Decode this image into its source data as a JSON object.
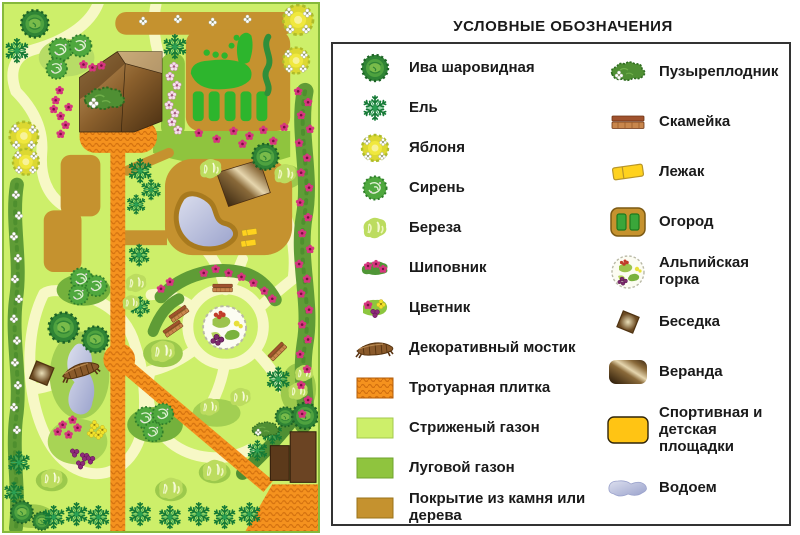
{
  "legend": {
    "title": "УСЛОВНЫЕ ОБОЗНАЧЕНИЯ",
    "left": [
      {
        "icon": "willow",
        "label": "Ива шаровидная"
      },
      {
        "icon": "spruce",
        "label": "Ель"
      },
      {
        "icon": "apple",
        "label": "Яблоня"
      },
      {
        "icon": "lilac",
        "label": "Сирень"
      },
      {
        "icon": "birch",
        "label": "Береза"
      },
      {
        "icon": "rosehip",
        "label": "Шиповник"
      },
      {
        "icon": "flowerbed",
        "label": "Цветник"
      },
      {
        "icon": "bridge",
        "label": "Декоративный мостик"
      },
      {
        "icon": "paving",
        "label": "Тротуарная плитка"
      },
      {
        "icon": "lawn_trim",
        "label": "Стриженый газон"
      },
      {
        "icon": "lawn_meadow",
        "label": "Луговой газон"
      },
      {
        "icon": "stone",
        "label": "Покрытие из камня или дерева"
      }
    ],
    "right": [
      {
        "icon": "ninebark",
        "label": "Пузыреплодник"
      },
      {
        "icon": "bench",
        "label": "Скамейка"
      },
      {
        "icon": "lounger",
        "label": "Лежак"
      },
      {
        "icon": "garden",
        "label": "Огород"
      },
      {
        "icon": "alpine",
        "label": "Альпийская горка"
      },
      {
        "icon": "gazebo",
        "label": "Беседка"
      },
      {
        "icon": "veranda",
        "label": "Веранда"
      },
      {
        "icon": "playground",
        "label": "Спортивная и детская площадки"
      },
      {
        "icon": "pond",
        "label": "Водоем"
      }
    ]
  },
  "palette": {
    "lawn_trim": "#cdef6a",
    "lawn_meadow": "#8fc43e",
    "walkway": "#f7f8c6",
    "hedge": "#5f9c36",
    "hedge_dark": "#4e8f2e",
    "paving": "#f5921e",
    "paving_dark": "#c96a08",
    "stone": "#c5922f",
    "stone_dark": "#a87a1e",
    "water_light": "#d4d8ea",
    "water_dark": "#8f97c6",
    "wood": "#6b4423",
    "wood_dark": "#3a2710",
    "pink": "#d6367f",
    "yellow": "#f2e32b",
    "purple": "#8e2a7a",
    "legend_border": "#333333",
    "title_color": "#1a1a1a",
    "page_bg": "#ffffff"
  },
  "map": {
    "features": [
      [
        "willow",
        31,
        20,
        1.05
      ],
      [
        "willow",
        263,
        154,
        1
      ],
      [
        "willow",
        60,
        326,
        1.15
      ],
      [
        "willow",
        92,
        338,
        1
      ],
      [
        "willow",
        18,
        512,
        0.85
      ],
      [
        "willow",
        38,
        521,
        0.7
      ],
      [
        "willow",
        283,
        416,
        0.75
      ],
      [
        "willow",
        303,
        415,
        1
      ],
      [
        "spruce",
        13,
        47,
        1
      ],
      [
        "spruce",
        172,
        43,
        1
      ],
      [
        "spruce",
        137,
        168,
        1
      ],
      [
        "spruce",
        148,
        187,
        0.85
      ],
      [
        "spruce",
        133,
        202,
        0.8
      ],
      [
        "spruce",
        136,
        253,
        0.9
      ],
      [
        "spruce",
        137,
        305,
        0.85
      ],
      [
        "spruce",
        276,
        378,
        1
      ],
      [
        "spruce",
        270,
        433,
        0.85
      ],
      [
        "spruce",
        255,
        450,
        0.85
      ],
      [
        "spruce",
        15,
        462,
        0.95
      ],
      [
        "spruce",
        10,
        492,
        0.85
      ],
      [
        "spruce",
        50,
        517,
        0.95
      ],
      [
        "spruce",
        73,
        514,
        0.95
      ],
      [
        "spruce",
        95,
        517,
        0.95
      ],
      [
        "spruce",
        137,
        514,
        0.95
      ],
      [
        "spruce",
        167,
        517,
        0.95
      ],
      [
        "spruce",
        196,
        514,
        0.95
      ],
      [
        "spruce",
        222,
        517,
        0.95
      ],
      [
        "spruce",
        247,
        514,
        0.95
      ],
      [
        "apple",
        296,
        16,
        1.15
      ],
      [
        "apple",
        294,
        57,
        1
      ],
      [
        "apple",
        20,
        133,
        1.1
      ],
      [
        "apple",
        22,
        159,
        1
      ],
      [
        "lilac",
        57,
        46,
        1
      ],
      [
        "lilac",
        77,
        42,
        0.95
      ],
      [
        "lilac",
        53,
        65,
        0.9
      ],
      [
        "lilac",
        78,
        277,
        0.95
      ],
      [
        "lilac",
        93,
        284,
        0.9
      ],
      [
        "lilac",
        75,
        293,
        0.85
      ],
      [
        "lilac",
        143,
        417,
        0.95
      ],
      [
        "lilac",
        160,
        413,
        0.9
      ],
      [
        "lilac",
        150,
        431,
        0.85
      ],
      [
        "birch",
        208,
        166,
        0.95
      ],
      [
        "birch",
        283,
        171,
        0.95
      ],
      [
        "birch",
        133,
        281,
        0.9
      ],
      [
        "birch",
        128,
        301,
        0.75
      ],
      [
        "birch",
        160,
        350,
        1.05
      ],
      [
        "birch",
        48,
        478,
        0.95
      ],
      [
        "birch",
        168,
        488,
        1.05
      ],
      [
        "birch",
        212,
        470,
        1.05
      ],
      [
        "birch",
        238,
        396,
        0.9
      ],
      [
        "birch",
        207,
        406,
        0.85
      ],
      [
        "birch",
        302,
        372,
        0.8
      ],
      [
        "birch",
        296,
        390,
        0.85
      ],
      [
        "ninebark",
        101,
        96,
        1.2
      ],
      [
        "ninebark",
        263,
        429,
        0.8
      ],
      [
        "blossom",
        171,
        63
      ],
      [
        "blossom",
        167,
        73
      ],
      [
        "blossom",
        174,
        82
      ],
      [
        "blossom",
        169,
        92
      ],
      [
        "blossom",
        166,
        102
      ],
      [
        "blossom",
        172,
        110
      ],
      [
        "blossom",
        169,
        119
      ],
      [
        "blossom",
        175,
        127
      ],
      [
        "pink",
        98,
        62
      ],
      [
        "pink",
        80,
        61
      ],
      [
        "pink",
        89,
        64
      ],
      [
        "pink",
        56,
        87
      ],
      [
        "pink",
        52,
        97
      ],
      [
        "pink",
        50,
        106
      ],
      [
        "pink",
        57,
        113
      ],
      [
        "pink",
        65,
        104
      ],
      [
        "pink",
        62,
        122
      ],
      [
        "pink",
        57,
        131
      ],
      [
        "pink",
        196,
        130
      ],
      [
        "pink",
        214,
        136
      ],
      [
        "pink",
        231,
        128
      ],
      [
        "pink",
        247,
        133
      ],
      [
        "pink",
        261,
        127
      ],
      [
        "pink",
        271,
        138
      ],
      [
        "pink",
        240,
        141
      ],
      [
        "pink",
        282,
        124
      ],
      [
        "pink",
        296,
        88
      ],
      [
        "pink",
        306,
        99
      ],
      [
        "pink",
        299,
        112
      ],
      [
        "pink",
        308,
        126
      ],
      [
        "pink",
        297,
        140
      ],
      [
        "pink",
        305,
        155
      ],
      [
        "pink",
        299,
        170
      ],
      [
        "pink",
        307,
        185
      ],
      [
        "pink",
        298,
        200
      ],
      [
        "pink",
        306,
        215
      ],
      [
        "pink",
        300,
        231
      ],
      [
        "pink",
        308,
        247
      ],
      [
        "pink",
        297,
        262
      ],
      [
        "pink",
        305,
        277
      ],
      [
        "pink",
        299,
        292
      ],
      [
        "pink",
        307,
        308
      ],
      [
        "pink",
        300,
        323
      ],
      [
        "pink",
        306,
        338
      ],
      [
        "pink",
        298,
        353
      ],
      [
        "pink",
        305,
        368
      ],
      [
        "pink",
        299,
        384
      ],
      [
        "pink",
        306,
        399
      ],
      [
        "pink",
        300,
        413
      ],
      [
        "pink",
        201,
        271
      ],
      [
        "pink",
        213,
        267
      ],
      [
        "pink",
        226,
        271
      ],
      [
        "pink",
        239,
        275
      ],
      [
        "pink",
        251,
        281
      ],
      [
        "pink",
        262,
        289
      ],
      [
        "pink",
        270,
        297
      ],
      [
        "pink",
        158,
        287
      ],
      [
        "pink",
        167,
        280
      ],
      [
        "pink",
        59,
        424
      ],
      [
        "pink",
        69,
        419
      ],
      [
        "pink",
        54,
        431
      ],
      [
        "pink",
        65,
        434
      ],
      [
        "pink",
        74,
        427
      ],
      [
        "purple",
        71,
        452
      ],
      [
        "purple",
        81,
        456
      ],
      [
        "purple",
        77,
        464
      ],
      [
        "purple",
        87,
        459
      ],
      [
        "yellow",
        91,
        424
      ],
      [
        "yellow",
        99,
        429
      ],
      [
        "yellow",
        88,
        432
      ],
      [
        "yellow",
        95,
        434
      ],
      [
        "white",
        12,
        192
      ],
      [
        "white",
        15,
        213
      ],
      [
        "white",
        10,
        234
      ],
      [
        "white",
        14,
        256
      ],
      [
        "white",
        11,
        277
      ],
      [
        "white",
        15,
        297
      ],
      [
        "white",
        10,
        317
      ],
      [
        "white",
        13,
        339
      ],
      [
        "white",
        11,
        361
      ],
      [
        "white",
        14,
        384
      ],
      [
        "white",
        10,
        406
      ],
      [
        "white",
        13,
        429
      ],
      [
        "white",
        140,
        17
      ],
      [
        "white",
        175,
        15
      ],
      [
        "white",
        210,
        18
      ],
      [
        "white",
        245,
        15
      ],
      [
        "bench",
        220,
        286,
        0.62,
        0
      ],
      [
        "bench",
        176,
        312,
        0.62,
        -35
      ],
      [
        "bench",
        170,
        327,
        0.62,
        -35
      ],
      [
        "bench",
        275,
        350,
        0.62,
        -45
      ],
      [
        "lounger",
        247,
        230,
        0.5,
        0
      ],
      [
        "lounger",
        246,
        241,
        0.5,
        0
      ],
      [
        "gazebo",
        38,
        372,
        1.1,
        0
      ],
      [
        "bridge",
        77,
        368,
        1.05,
        -12
      ],
      [
        "alpine",
        222,
        326,
        1.35,
        0
      ]
    ]
  }
}
